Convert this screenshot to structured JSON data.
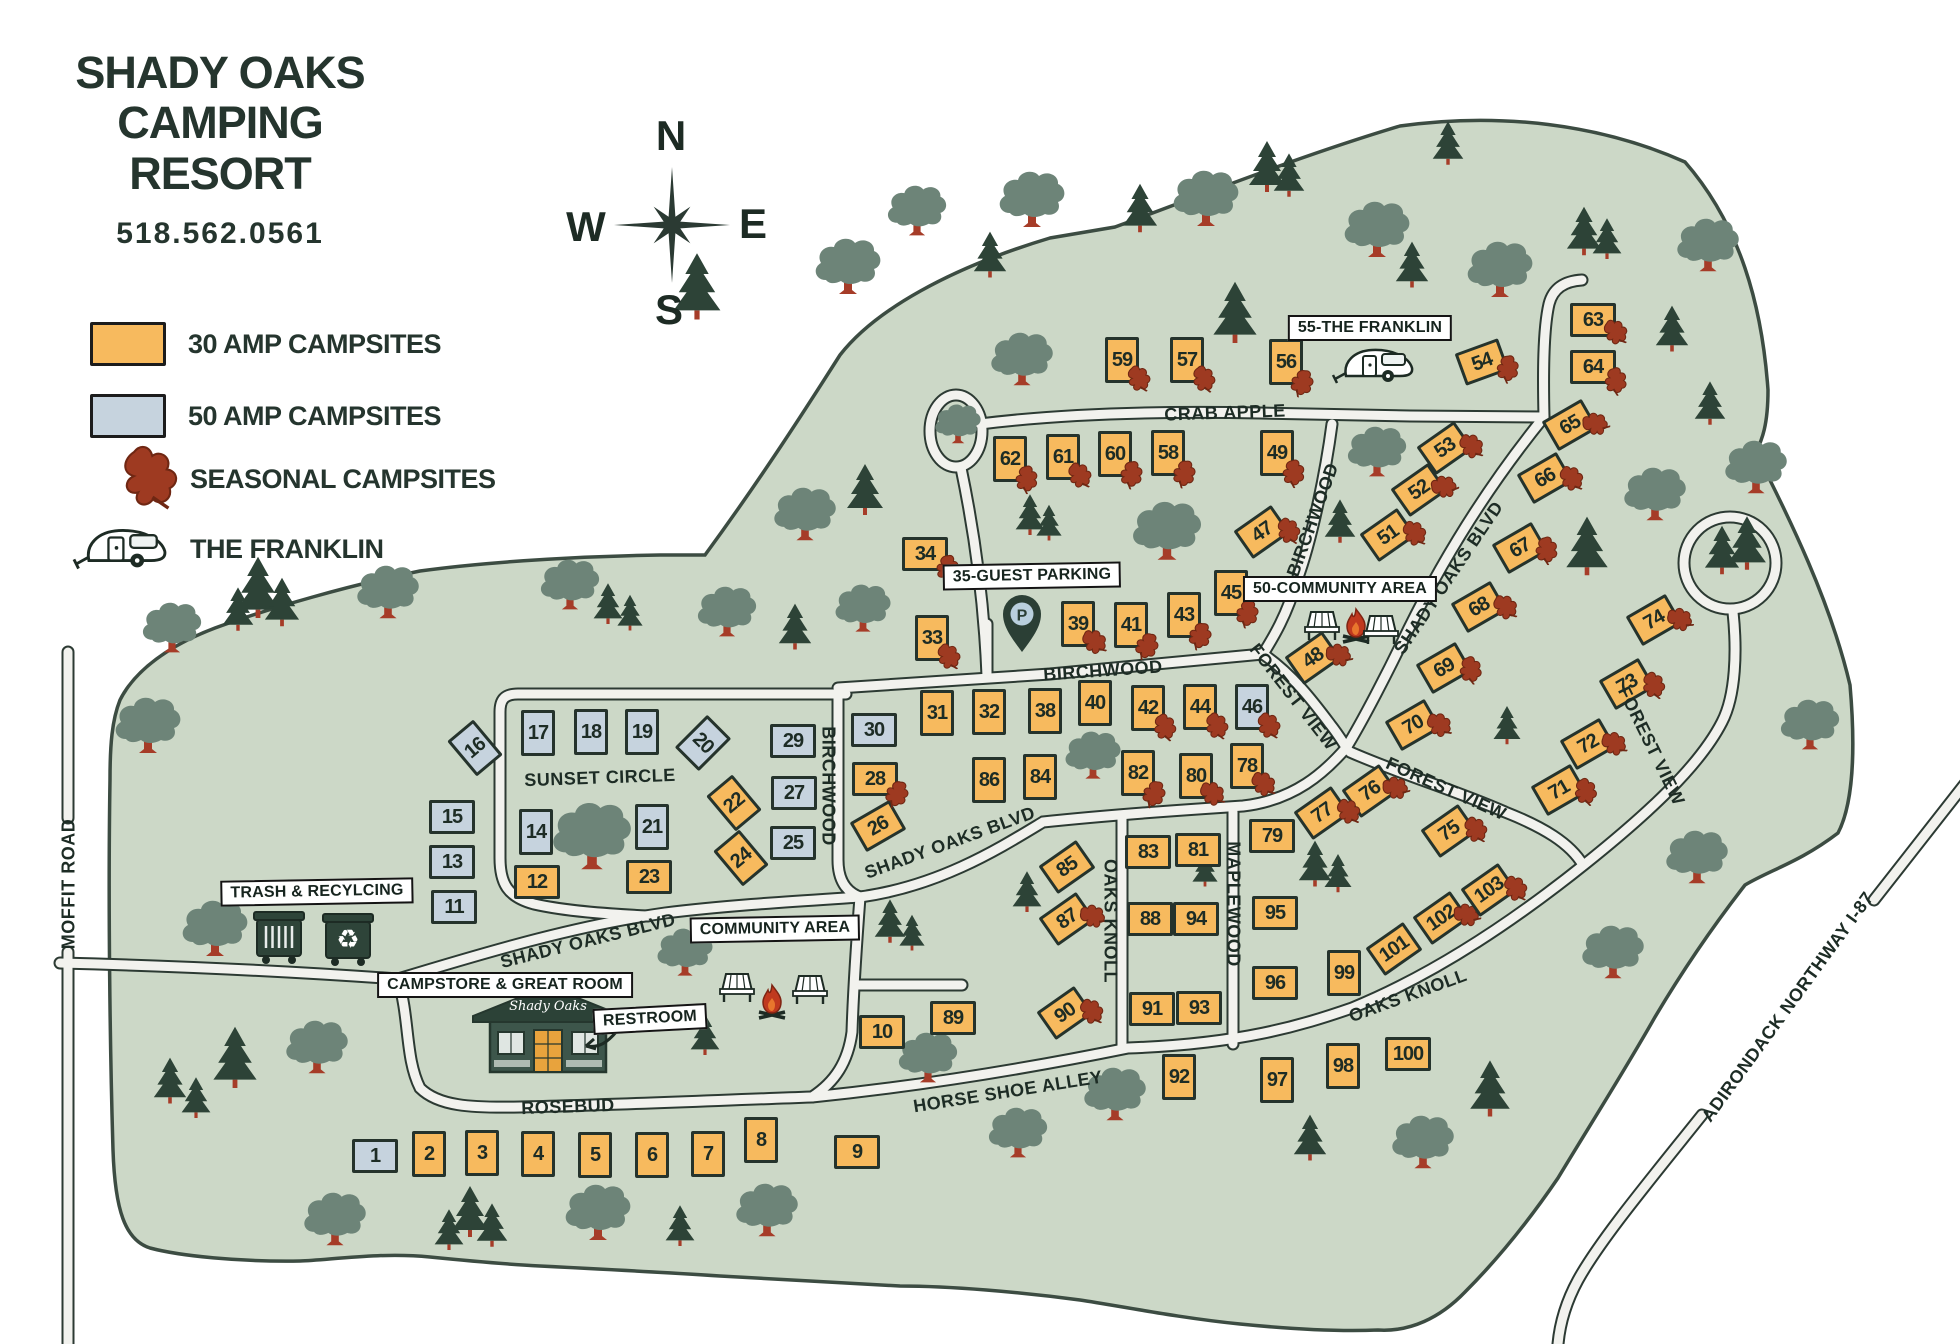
{
  "title": {
    "line1": "SHADY OAKS",
    "line2": "CAMPING RESORT",
    "phone": "518.562.0561"
  },
  "legend": {
    "items": [
      {
        "name": "30-amp-campsites",
        "label": "30 AMP CAMPSITES"
      },
      {
        "name": "50-amp-campsites",
        "label": "50 AMP CAMPSITES"
      },
      {
        "name": "seasonal-campsites",
        "label": "SEASONAL CAMPSITES"
      },
      {
        "name": "the-franklin",
        "label": "THE FRANKLIN"
      }
    ]
  },
  "compass": {
    "n": "N",
    "e": "E",
    "s": "S",
    "w": "W"
  },
  "colors": {
    "amp30": "#f7ba5e",
    "amp50": "#c6d3de",
    "seasonal_leaf": "#9e3a21",
    "map_green": "#ccd8c7",
    "road": "#f2f2ee",
    "ink": "#25332c",
    "tree_deciduous": "#6d8478",
    "tree_conifer": "#2d4337",
    "trunk": "#a63c28"
  },
  "road_labels": [
    {
      "text": "CRAB APPLE",
      "x": 1225,
      "y": 413,
      "rot": -2
    },
    {
      "text": "BIRCHWOOD",
      "x": 1103,
      "y": 671,
      "rot": -4
    },
    {
      "text": "BIRCHWOOD",
      "x": 828,
      "y": 786,
      "rot": 90
    },
    {
      "text": "BIRCHWOOD",
      "x": 1313,
      "y": 520,
      "rot": -70
    },
    {
      "text": "SUNSET CIRCLE",
      "x": 600,
      "y": 778,
      "rot": -2
    },
    {
      "text": "SHADY OAKS BLVD",
      "x": 588,
      "y": 941,
      "rot": -14
    },
    {
      "text": "SHADY OAKS BLVD",
      "x": 950,
      "y": 843,
      "rot": -20
    },
    {
      "text": "SHADY OAKS BLVD",
      "x": 1449,
      "y": 578,
      "rot": -56
    },
    {
      "text": "FOREST VIEW",
      "x": 1293,
      "y": 697,
      "rot": 52
    },
    {
      "text": "FOREST VIEW",
      "x": 1446,
      "y": 789,
      "rot": 24
    },
    {
      "text": "FOREST VIEW",
      "x": 1651,
      "y": 746,
      "rot": 64
    },
    {
      "text": "OAKS KNOLL",
      "x": 1110,
      "y": 921,
      "rot": 90
    },
    {
      "text": "OAKS KNOLL",
      "x": 1408,
      "y": 996,
      "rot": -20
    },
    {
      "text": "MAPLEWOOD",
      "x": 1233,
      "y": 904,
      "rot": 90
    },
    {
      "text": "HORSE SHOE ALLEY",
      "x": 1008,
      "y": 1092,
      "rot": -9
    },
    {
      "text": "ROSEBUD",
      "x": 568,
      "y": 1107,
      "rot": -2
    },
    {
      "text": "MOFFIT ROAD",
      "x": 69,
      "y": 884,
      "rot": -90
    },
    {
      "text": "ADIRONDACK NORTHWAY I-87",
      "x": 1788,
      "y": 1007,
      "rot": -54
    }
  ],
  "poi_labels": [
    {
      "text": "55-THE FRANKLIN",
      "x": 1370,
      "y": 328,
      "rot": 0
    },
    {
      "text": "35-GUEST PARKING",
      "x": 1032,
      "y": 576,
      "rot": -1
    },
    {
      "text": "50-COMMUNITY AREA",
      "x": 1340,
      "y": 589,
      "rot": 0
    },
    {
      "text": "TRASH & RECYLCING",
      "x": 317,
      "y": 892,
      "rot": -1
    },
    {
      "text": "CAMPSTORE & GREAT ROOM",
      "x": 505,
      "y": 985,
      "rot": 0
    },
    {
      "text": "RESTROOM",
      "x": 650,
      "y": 1019,
      "rot": -3
    },
    {
      "text": "COMMUNITY AREA",
      "x": 775,
      "y": 929,
      "rot": -1
    }
  ],
  "sites": [
    {
      "n": 1,
      "x": 375,
      "y": 1156,
      "amp": "50",
      "o": "h",
      "rot": 0,
      "leaf": false
    },
    {
      "n": 2,
      "x": 429,
      "y": 1154,
      "amp": "30",
      "o": "v",
      "rot": 0,
      "leaf": false
    },
    {
      "n": 3,
      "x": 482,
      "y": 1153,
      "amp": "30",
      "o": "v",
      "rot": 0,
      "leaf": false
    },
    {
      "n": 4,
      "x": 538,
      "y": 1154,
      "amp": "30",
      "o": "v",
      "rot": 0,
      "leaf": false
    },
    {
      "n": 5,
      "x": 595,
      "y": 1155,
      "amp": "30",
      "o": "v",
      "rot": 0,
      "leaf": false
    },
    {
      "n": 6,
      "x": 652,
      "y": 1155,
      "amp": "30",
      "o": "v",
      "rot": 0,
      "leaf": false
    },
    {
      "n": 7,
      "x": 708,
      "y": 1154,
      "amp": "30",
      "o": "v",
      "rot": 0,
      "leaf": false
    },
    {
      "n": 8,
      "x": 761,
      "y": 1140,
      "amp": "30",
      "o": "v",
      "rot": 0,
      "leaf": false
    },
    {
      "n": 9,
      "x": 857,
      "y": 1152,
      "amp": "30",
      "o": "h",
      "rot": 0,
      "leaf": false
    },
    {
      "n": 10,
      "x": 882,
      "y": 1032,
      "amp": "30",
      "o": "h",
      "rot": 0,
      "leaf": false
    },
    {
      "n": 11,
      "x": 454,
      "y": 907,
      "amp": "50",
      "o": "h",
      "rot": 0,
      "leaf": false
    },
    {
      "n": 12,
      "x": 537,
      "y": 882,
      "amp": "30",
      "o": "h",
      "rot": 0,
      "leaf": false
    },
    {
      "n": 13,
      "x": 452,
      "y": 862,
      "amp": "50",
      "o": "h",
      "rot": 0,
      "leaf": false
    },
    {
      "n": 14,
      "x": 536,
      "y": 832,
      "amp": "50",
      "o": "v",
      "rot": 0,
      "leaf": false
    },
    {
      "n": 15,
      "x": 452,
      "y": 817,
      "amp": "50",
      "o": "h",
      "rot": 0,
      "leaf": false
    },
    {
      "n": 16,
      "x": 475,
      "y": 748,
      "amp": "50",
      "o": "v",
      "rot": -40,
      "leaf": false
    },
    {
      "n": 17,
      "x": 538,
      "y": 733,
      "amp": "50",
      "o": "v",
      "rot": 0,
      "leaf": false
    },
    {
      "n": 18,
      "x": 591,
      "y": 732,
      "amp": "50",
      "o": "v",
      "rot": 0,
      "leaf": false
    },
    {
      "n": 19,
      "x": 642,
      "y": 732,
      "amp": "50",
      "o": "v",
      "rot": 0,
      "leaf": false
    },
    {
      "n": 20,
      "x": 703,
      "y": 743,
      "amp": "50",
      "o": "v",
      "rot": 45,
      "leaf": false
    },
    {
      "n": 21,
      "x": 652,
      "y": 827,
      "amp": "50",
      "o": "v",
      "rot": 0,
      "leaf": false
    },
    {
      "n": 22,
      "x": 734,
      "y": 803,
      "amp": "30",
      "o": "v",
      "rot": -40,
      "leaf": false
    },
    {
      "n": 23,
      "x": 649,
      "y": 877,
      "amp": "30",
      "o": "h",
      "rot": 0,
      "leaf": false
    },
    {
      "n": 24,
      "x": 741,
      "y": 858,
      "amp": "30",
      "o": "v",
      "rot": -40,
      "leaf": false
    },
    {
      "n": 25,
      "x": 793,
      "y": 843,
      "amp": "50",
      "o": "h",
      "rot": 0,
      "leaf": false
    },
    {
      "n": 26,
      "x": 878,
      "y": 826,
      "amp": "30",
      "o": "h",
      "rot": -30,
      "leaf": false
    },
    {
      "n": 27,
      "x": 794,
      "y": 793,
      "amp": "50",
      "o": "h",
      "rot": 0,
      "leaf": false
    },
    {
      "n": 28,
      "x": 875,
      "y": 779,
      "amp": "30",
      "o": "h",
      "rot": 0,
      "leaf": true
    },
    {
      "n": 29,
      "x": 793,
      "y": 741,
      "amp": "50",
      "o": "h",
      "rot": 0,
      "leaf": false
    },
    {
      "n": 30,
      "x": 874,
      "y": 730,
      "amp": "50",
      "o": "h",
      "rot": 0,
      "leaf": false
    },
    {
      "n": 31,
      "x": 937,
      "y": 713,
      "amp": "30",
      "o": "v",
      "rot": 0,
      "leaf": false
    },
    {
      "n": 32,
      "x": 989,
      "y": 712,
      "amp": "30",
      "o": "v",
      "rot": 0,
      "leaf": false
    },
    {
      "n": 33,
      "x": 932,
      "y": 638,
      "amp": "30",
      "o": "v",
      "rot": 0,
      "leaf": true
    },
    {
      "n": 34,
      "x": 925,
      "y": 554,
      "amp": "30",
      "o": "h",
      "rot": 0,
      "leaf": true
    },
    {
      "n": 38,
      "x": 1045,
      "y": 711,
      "amp": "30",
      "o": "v",
      "rot": 0,
      "leaf": false
    },
    {
      "n": 39,
      "x": 1078,
      "y": 624,
      "amp": "30",
      "o": "v",
      "rot": 0,
      "leaf": true
    },
    {
      "n": 40,
      "x": 1095,
      "y": 703,
      "amp": "30",
      "o": "v",
      "rot": 0,
      "leaf": false
    },
    {
      "n": 41,
      "x": 1131,
      "y": 625,
      "amp": "30",
      "o": "v",
      "rot": 0,
      "leaf": true
    },
    {
      "n": 42,
      "x": 1148,
      "y": 708,
      "amp": "30",
      "o": "v",
      "rot": 0,
      "leaf": true
    },
    {
      "n": 43,
      "x": 1184,
      "y": 615,
      "amp": "30",
      "o": "v",
      "rot": 0,
      "leaf": true
    },
    {
      "n": 44,
      "x": 1200,
      "y": 707,
      "amp": "30",
      "o": "v",
      "rot": 0,
      "leaf": true
    },
    {
      "n": 45,
      "x": 1231,
      "y": 593,
      "amp": "30",
      "o": "v",
      "rot": 0,
      "leaf": true
    },
    {
      "n": 46,
      "x": 1252,
      "y": 707,
      "amp": "50",
      "o": "v",
      "rot": 0,
      "leaf": true
    },
    {
      "n": 47,
      "x": 1262,
      "y": 532,
      "amp": "30",
      "o": "h",
      "rot": -35,
      "leaf": true
    },
    {
      "n": 48,
      "x": 1313,
      "y": 658,
      "amp": "30",
      "o": "h",
      "rot": -35,
      "leaf": true
    },
    {
      "n": 49,
      "x": 1277,
      "y": 453,
      "amp": "30",
      "o": "v",
      "rot": 0,
      "leaf": true
    },
    {
      "n": 51,
      "x": 1388,
      "y": 535,
      "amp": "30",
      "o": "h",
      "rot": -35,
      "leaf": true
    },
    {
      "n": 52,
      "x": 1419,
      "y": 490,
      "amp": "30",
      "o": "h",
      "rot": -35,
      "leaf": true
    },
    {
      "n": 53,
      "x": 1445,
      "y": 448,
      "amp": "30",
      "o": "h",
      "rot": -35,
      "leaf": true
    },
    {
      "n": 54,
      "x": 1482,
      "y": 362,
      "amp": "30",
      "o": "h",
      "rot": -20,
      "leaf": true
    },
    {
      "n": 56,
      "x": 1286,
      "y": 362,
      "amp": "30",
      "o": "v",
      "rot": 0,
      "leaf": true
    },
    {
      "n": 57,
      "x": 1187,
      "y": 360,
      "amp": "30",
      "o": "v",
      "rot": 0,
      "leaf": true
    },
    {
      "n": 58,
      "x": 1168,
      "y": 453,
      "amp": "30",
      "o": "v",
      "rot": 0,
      "leaf": true
    },
    {
      "n": 59,
      "x": 1122,
      "y": 360,
      "amp": "30",
      "o": "v",
      "rot": 0,
      "leaf": true
    },
    {
      "n": 60,
      "x": 1115,
      "y": 454,
      "amp": "30",
      "o": "v",
      "rot": 0,
      "leaf": true
    },
    {
      "n": 61,
      "x": 1063,
      "y": 457,
      "amp": "30",
      "o": "v",
      "rot": 0,
      "leaf": true
    },
    {
      "n": 62,
      "x": 1010,
      "y": 459,
      "amp": "30",
      "o": "v",
      "rot": 0,
      "leaf": true
    },
    {
      "n": 63,
      "x": 1593,
      "y": 320,
      "amp": "30",
      "o": "h",
      "rot": 0,
      "leaf": true
    },
    {
      "n": 64,
      "x": 1593,
      "y": 367,
      "amp": "30",
      "o": "h",
      "rot": 0,
      "leaf": true
    },
    {
      "n": 65,
      "x": 1570,
      "y": 425,
      "amp": "30",
      "o": "h",
      "rot": -30,
      "leaf": true
    },
    {
      "n": 66,
      "x": 1545,
      "y": 478,
      "amp": "30",
      "o": "h",
      "rot": -30,
      "leaf": true
    },
    {
      "n": 67,
      "x": 1520,
      "y": 548,
      "amp": "30",
      "o": "h",
      "rot": -30,
      "leaf": true
    },
    {
      "n": 68,
      "x": 1479,
      "y": 607,
      "amp": "30",
      "o": "h",
      "rot": -30,
      "leaf": true
    },
    {
      "n": 69,
      "x": 1444,
      "y": 668,
      "amp": "30",
      "o": "h",
      "rot": -30,
      "leaf": true
    },
    {
      "n": 70,
      "x": 1413,
      "y": 725,
      "amp": "30",
      "o": "h",
      "rot": -30,
      "leaf": true
    },
    {
      "n": 71,
      "x": 1559,
      "y": 790,
      "amp": "30",
      "o": "h",
      "rot": -30,
      "leaf": true
    },
    {
      "n": 72,
      "x": 1588,
      "y": 744,
      "amp": "30",
      "o": "h",
      "rot": -30,
      "leaf": true
    },
    {
      "n": 73,
      "x": 1627,
      "y": 684,
      "amp": "30",
      "o": "h",
      "rot": -30,
      "leaf": true
    },
    {
      "n": 74,
      "x": 1654,
      "y": 620,
      "amp": "30",
      "o": "h",
      "rot": -30,
      "leaf": true
    },
    {
      "n": 75,
      "x": 1449,
      "y": 831,
      "amp": "30",
      "o": "h",
      "rot": -35,
      "leaf": true
    },
    {
      "n": 76,
      "x": 1370,
      "y": 791,
      "amp": "30",
      "o": "h",
      "rot": -35,
      "leaf": true
    },
    {
      "n": 77,
      "x": 1322,
      "y": 813,
      "amp": "30",
      "o": "h",
      "rot": -35,
      "leaf": true
    },
    {
      "n": 78,
      "x": 1247,
      "y": 766,
      "amp": "30",
      "o": "v",
      "rot": 0,
      "leaf": true
    },
    {
      "n": 79,
      "x": 1272,
      "y": 836,
      "amp": "30",
      "o": "h",
      "rot": 0,
      "leaf": false
    },
    {
      "n": 80,
      "x": 1196,
      "y": 776,
      "amp": "30",
      "o": "v",
      "rot": 0,
      "leaf": true
    },
    {
      "n": 81,
      "x": 1198,
      "y": 850,
      "amp": "30",
      "o": "h",
      "rot": 0,
      "leaf": false
    },
    {
      "n": 82,
      "x": 1138,
      "y": 773,
      "amp": "30",
      "o": "v",
      "rot": 0,
      "leaf": true
    },
    {
      "n": 83,
      "x": 1148,
      "y": 852,
      "amp": "30",
      "o": "h",
      "rot": 0,
      "leaf": false
    },
    {
      "n": 84,
      "x": 1040,
      "y": 777,
      "amp": "30",
      "o": "v",
      "rot": 0,
      "leaf": false
    },
    {
      "n": 85,
      "x": 1067,
      "y": 867,
      "amp": "30",
      "o": "h",
      "rot": -35,
      "leaf": false
    },
    {
      "n": 86,
      "x": 989,
      "y": 780,
      "amp": "30",
      "o": "v",
      "rot": 0,
      "leaf": false
    },
    {
      "n": 87,
      "x": 1067,
      "y": 919,
      "amp": "30",
      "o": "h",
      "rot": -35,
      "leaf": true
    },
    {
      "n": 88,
      "x": 1150,
      "y": 919,
      "amp": "30",
      "o": "h",
      "rot": 0,
      "leaf": false
    },
    {
      "n": 89,
      "x": 953,
      "y": 1018,
      "amp": "30",
      "o": "h",
      "rot": 0,
      "leaf": false
    },
    {
      "n": 90,
      "x": 1065,
      "y": 1013,
      "amp": "30",
      "o": "h",
      "rot": -35,
      "leaf": true
    },
    {
      "n": 91,
      "x": 1152,
      "y": 1009,
      "amp": "30",
      "o": "h",
      "rot": 0,
      "leaf": false
    },
    {
      "n": 92,
      "x": 1179,
      "y": 1077,
      "amp": "30",
      "o": "v",
      "rot": 0,
      "leaf": false
    },
    {
      "n": 93,
      "x": 1199,
      "y": 1008,
      "amp": "30",
      "o": "h",
      "rot": 0,
      "leaf": false
    },
    {
      "n": 94,
      "x": 1196,
      "y": 919,
      "amp": "30",
      "o": "h",
      "rot": 0,
      "leaf": false
    },
    {
      "n": 95,
      "x": 1275,
      "y": 913,
      "amp": "30",
      "o": "h",
      "rot": 0,
      "leaf": false
    },
    {
      "n": 96,
      "x": 1275,
      "y": 983,
      "amp": "30",
      "o": "h",
      "rot": 0,
      "leaf": false
    },
    {
      "n": 97,
      "x": 1277,
      "y": 1080,
      "amp": "30",
      "o": "v",
      "rot": 0,
      "leaf": false
    },
    {
      "n": 98,
      "x": 1343,
      "y": 1066,
      "amp": "30",
      "o": "v",
      "rot": 0,
      "leaf": false
    },
    {
      "n": 99,
      "x": 1344,
      "y": 973,
      "amp": "30",
      "o": "v",
      "rot": 0,
      "leaf": false
    },
    {
      "n": 100,
      "x": 1408,
      "y": 1054,
      "amp": "30",
      "o": "h",
      "rot": 0,
      "leaf": false
    },
    {
      "n": 101,
      "x": 1394,
      "y": 949,
      "amp": "30",
      "o": "h",
      "rot": -35,
      "leaf": false
    },
    {
      "n": 102,
      "x": 1441,
      "y": 918,
      "amp": "30",
      "o": "h",
      "rot": -35,
      "leaf": true
    },
    {
      "n": 103,
      "x": 1489,
      "y": 890,
      "amp": "30",
      "o": "h",
      "rot": -35,
      "leaf": true
    }
  ]
}
